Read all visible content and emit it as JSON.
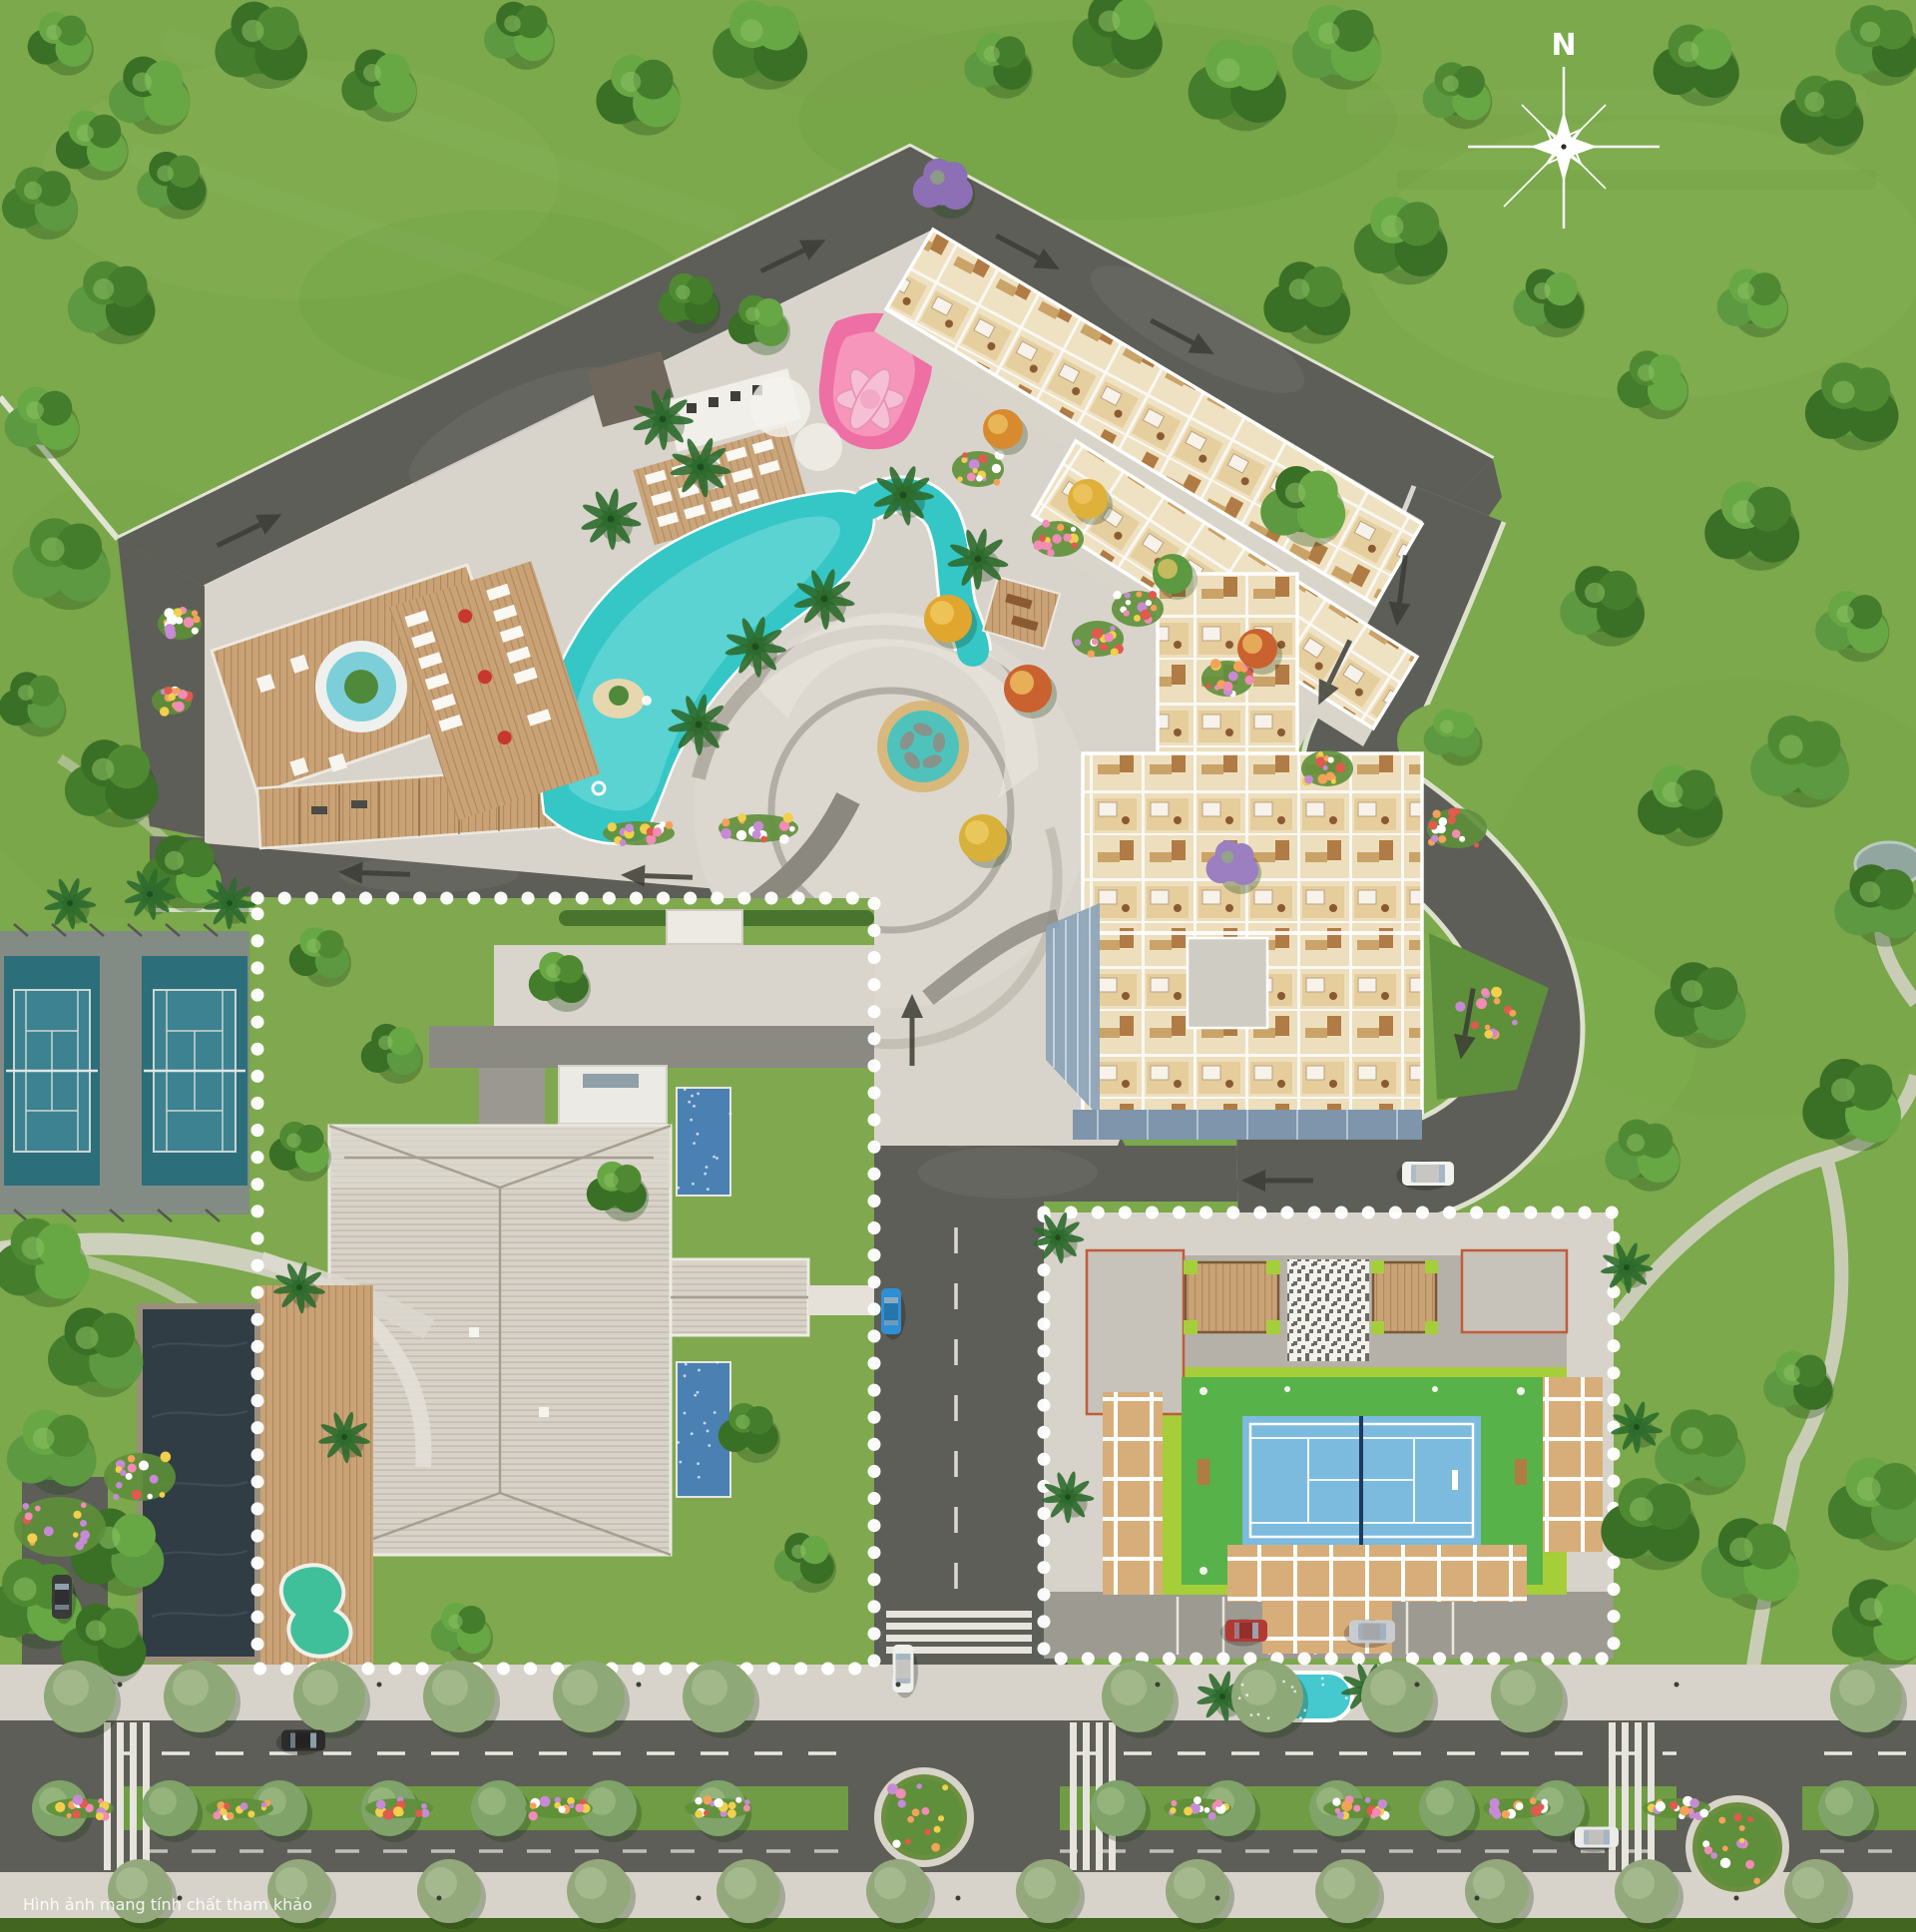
{
  "compass": {
    "label": "N"
  },
  "caption": {
    "text": "Hình ảnh mang tính chất tham khảo"
  },
  "colors": {
    "grass": "#7BA94B",
    "grass_light": "#8FBA5C",
    "grass_dark": "#69983D",
    "asphalt": "#5D5E57",
    "paving": "#D8D4CB",
    "sidewalk": "#D7D3CA",
    "wood": "#D2B084",
    "pool": "#35C6C6",
    "pool_light": "#7FE0DE",
    "pond": "#313D44",
    "kidney_pool": "#3FC09B",
    "oval_pool": "#46C8CF",
    "lap_pool": "#4B80B3",
    "court_pad": "#828C84",
    "court_teal": "#2C6E7A",
    "court_teal_inner": "#3C8291",
    "lime_turf": "#A6CE39",
    "rooftop_court_green": "#58B24A",
    "rooftop_court_blue": "#7CBADE",
    "roof": "#D8D2C8",
    "roof_flat": "#ECEAE4",
    "glass": "#8BA3B8",
    "unit_floor": "#EFE2C2",
    "lotus_pond": "#EE6FA3",
    "lotus_petal": "#F6C3D6",
    "median_green": "#6F9C44",
    "arrow": "#3C3D37",
    "boundary_dots": "#FFFFFF",
    "terracotta_trim": "#C05C3A"
  }
}
